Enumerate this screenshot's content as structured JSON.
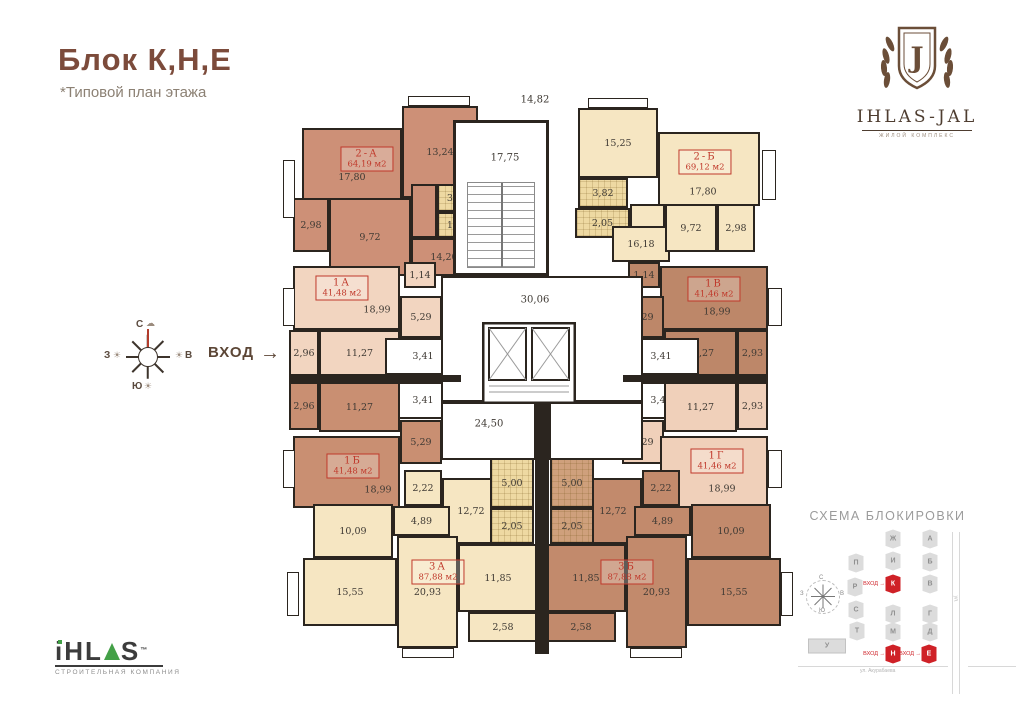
{
  "header": {
    "title": "Блок К,Н,Е",
    "subtitle": "*Типовой план этажа"
  },
  "brand_top": {
    "monogram": "J",
    "name": "IHLAS-JAL",
    "tagline": "ЖИЛОЙ КОМПЛЕКС"
  },
  "brand_bottom": {
    "name_pre": "iHL",
    "name_post": "S",
    "tm": "™",
    "tagline": "СТРОИТЕЛЬНАЯ КОМПАНИЯ"
  },
  "entrance": {
    "label": "ВХОД",
    "arrow": "→"
  },
  "compass": {
    "n": "С",
    "s": "Ю",
    "w": "З",
    "e": "В",
    "cloud": "☁",
    "sun": "☀"
  },
  "plan": {
    "wall_color": "#2b251f",
    "label_color": "#c0392b",
    "apartments": [
      {
        "id": "2A",
        "name": "2-А",
        "area": "64,19 м2",
        "color": "#cd9077",
        "label_x": 367,
        "label_y": 159
      },
      {
        "id": "2B",
        "name": "2-Б",
        "area": "69,12 м2",
        "color": "#f6e6c2",
        "label_x": 705,
        "label_y": 162
      },
      {
        "id": "1A",
        "name": "1А",
        "area": "41,48 м2",
        "color": "#f2d5c0",
        "label_x": 342,
        "label_y": 288
      },
      {
        "id": "1V",
        "name": "1В",
        "area": "41,46 м2",
        "color": "#bd8769",
        "label_x": 714,
        "label_y": 289
      },
      {
        "id": "1B",
        "name": "1Б",
        "area": "41,48 м2",
        "color": "#c98f72",
        "label_x": 353,
        "label_y": 466
      },
      {
        "id": "1G",
        "name": "1Г",
        "area": "41,46 м2",
        "color": "#f0d0ba",
        "label_x": 717,
        "label_y": 461
      },
      {
        "id": "3A",
        "name": "3А",
        "area": "87,88 м2",
        "color": "#f6e6c2",
        "label_x": 438,
        "label_y": 572
      },
      {
        "id": "3B",
        "name": "3Б",
        "area": "87,88 м2",
        "color": "#c28a6c",
        "label_x": 627,
        "label_y": 572
      }
    ],
    "rooms": [
      {
        "apt": "2A",
        "label": "17,80",
        "x": 302,
        "y": 128,
        "w": 100,
        "h": 98
      },
      {
        "apt": "2A",
        "label": "13,24",
        "x": 402,
        "y": 106,
        "w": 76,
        "h": 92
      },
      {
        "apt": "2A",
        "label": "2,98",
        "x": 293,
        "y": 198,
        "w": 36,
        "h": 54
      },
      {
        "apt": "2A",
        "label": "9,72",
        "x": 329,
        "y": 198,
        "w": 82,
        "h": 78
      },
      {
        "apt": "2A",
        "label": "",
        "x": 411,
        "y": 184,
        "w": 26,
        "h": 54
      },
      {
        "apt": "2A",
        "label": "3,26",
        "x": 437,
        "y": 184,
        "w": 41,
        "h": 28,
        "bg": "#eed9a2",
        "tile": true
      },
      {
        "apt": "2A",
        "label": "1,66",
        "x": 437,
        "y": 212,
        "w": 41,
        "h": 26,
        "bg": "#eed9a2",
        "tile": true
      },
      {
        "apt": "2A",
        "label": "14,20",
        "x": 411,
        "y": 238,
        "w": 66,
        "h": 38
      },
      {
        "apt": "1A",
        "label": "18,99",
        "x": 293,
        "y": 266,
        "w": 107,
        "h": 64,
        "lx": 82,
        "ly": 42
      },
      {
        "apt": "1A",
        "label": "1,14",
        "x": 404,
        "y": 262,
        "w": 32,
        "h": 26
      },
      {
        "apt": "1A",
        "label": "5,29",
        "x": 400,
        "y": 296,
        "w": 42,
        "h": 42
      },
      {
        "apt": "1A",
        "label": "2,96",
        "x": 289,
        "y": 330,
        "w": 30,
        "h": 46
      },
      {
        "apt": "1A",
        "label": "11,27",
        "x": 319,
        "y": 330,
        "w": 81,
        "h": 46
      },
      {
        "apt": "1A",
        "label": "3,41",
        "x": 385,
        "y": 338,
        "w": 76,
        "h": 37,
        "white": true
      },
      {
        "apt": "1B",
        "label": "3,41",
        "x": 385,
        "y": 382,
        "w": 76,
        "h": 37,
        "white": true
      },
      {
        "apt": "1B",
        "label": "2,96",
        "x": 289,
        "y": 382,
        "w": 30,
        "h": 48
      },
      {
        "apt": "1B",
        "label": "11,27",
        "x": 319,
        "y": 382,
        "w": 81,
        "h": 50
      },
      {
        "apt": "1B",
        "label": "5,29",
        "x": 400,
        "y": 420,
        "w": 42,
        "h": 44
      },
      {
        "apt": "1B",
        "label": "18,99",
        "x": 293,
        "y": 436,
        "w": 107,
        "h": 72,
        "lx": 83,
        "ly": 52
      },
      {
        "apt": "3A",
        "label": "2,22",
        "x": 404,
        "y": 470,
        "w": 38,
        "h": 36
      },
      {
        "apt": "3A",
        "label": "12,72",
        "x": 442,
        "y": 478,
        "w": 58,
        "h": 66
      },
      {
        "apt": "3A",
        "label": "4,89",
        "x": 393,
        "y": 506,
        "w": 57,
        "h": 30
      },
      {
        "apt": "3A",
        "label": "10,09",
        "x": 313,
        "y": 504,
        "w": 80,
        "h": 54
      },
      {
        "apt": "3A",
        "label": "15,55",
        "x": 303,
        "y": 558,
        "w": 94,
        "h": 68
      },
      {
        "apt": "3A",
        "label": "20,93",
        "x": 397,
        "y": 536,
        "w": 61,
        "h": 112
      },
      {
        "apt": "3A",
        "label": "5,00",
        "x": 490,
        "y": 458,
        "w": 44,
        "h": 50,
        "bg": "#eed9a2",
        "tile": true
      },
      {
        "apt": "3A",
        "label": "2,05",
        "x": 490,
        "y": 508,
        "w": 44,
        "h": 36,
        "bg": "#eed9a2",
        "tile": true
      },
      {
        "apt": "3A",
        "label": "11,85",
        "x": 458,
        "y": 544,
        "w": 80,
        "h": 68
      },
      {
        "apt": "3A",
        "label": "2,58",
        "x": 468,
        "y": 612,
        "w": 70,
        "h": 30
      },
      {
        "apt": "2B",
        "label": "15,25",
        "x": 578,
        "y": 108,
        "w": 80,
        "h": 70
      },
      {
        "apt": "2B",
        "label": "17,80",
        "x": 658,
        "y": 132,
        "w": 102,
        "h": 74,
        "lx": 43,
        "ly": 58
      },
      {
        "apt": "2B",
        "label": "3,82",
        "x": 578,
        "y": 178,
        "w": 50,
        "h": 30,
        "bg": "#eed9a2",
        "tile": true
      },
      {
        "apt": "2B",
        "label": "2,05",
        "x": 575,
        "y": 208,
        "w": 55,
        "h": 30,
        "bg": "#eed9a2",
        "tile": true
      },
      {
        "apt": "2B",
        "label": "16,18",
        "x": 612,
        "y": 226,
        "w": 58,
        "h": 36
      },
      {
        "apt": "2B",
        "label": "",
        "x": 630,
        "y": 204,
        "w": 35,
        "h": 24
      },
      {
        "apt": "2B",
        "label": "9,72",
        "x": 665,
        "y": 204,
        "w": 52,
        "h": 48
      },
      {
        "apt": "2B",
        "label": "2,98",
        "x": 717,
        "y": 204,
        "w": 38,
        "h": 48
      },
      {
        "apt": "1V",
        "label": "1,14",
        "x": 628,
        "y": 262,
        "w": 32,
        "h": 26
      },
      {
        "apt": "1V",
        "label": "18,99",
        "x": 660,
        "y": 266,
        "w": 108,
        "h": 64,
        "lx": 55,
        "ly": 44
      },
      {
        "apt": "1V",
        "label": "5,29",
        "x": 622,
        "y": 296,
        "w": 42,
        "h": 42
      },
      {
        "apt": "1V",
        "label": "11,27",
        "x": 664,
        "y": 330,
        "w": 73,
        "h": 46
      },
      {
        "apt": "1V",
        "label": "2,93",
        "x": 737,
        "y": 330,
        "w": 31,
        "h": 46
      },
      {
        "apt": "1V",
        "label": "3,41",
        "x": 623,
        "y": 338,
        "w": 76,
        "h": 37,
        "white": true
      },
      {
        "apt": "1G",
        "label": "3,41",
        "x": 623,
        "y": 382,
        "w": 76,
        "h": 37,
        "white": true
      },
      {
        "apt": "1G",
        "label": "11,27",
        "x": 664,
        "y": 382,
        "w": 73,
        "h": 50
      },
      {
        "apt": "1G",
        "label": "2,93",
        "x": 737,
        "y": 382,
        "w": 31,
        "h": 48
      },
      {
        "apt": "1G",
        "label": "5,29",
        "x": 622,
        "y": 420,
        "w": 42,
        "h": 44
      },
      {
        "apt": "1G",
        "label": "18,99",
        "x": 660,
        "y": 436,
        "w": 108,
        "h": 72,
        "lx": 60,
        "ly": 51
      },
      {
        "apt": "3B",
        "label": "2,22",
        "x": 642,
        "y": 470,
        "w": 38,
        "h": 36
      },
      {
        "apt": "3B",
        "label": "12,72",
        "x": 584,
        "y": 478,
        "w": 58,
        "h": 66
      },
      {
        "apt": "3B",
        "label": "4,89",
        "x": 634,
        "y": 506,
        "w": 57,
        "h": 30
      },
      {
        "apt": "3B",
        "label": "10,09",
        "x": 691,
        "y": 504,
        "w": 80,
        "h": 54
      },
      {
        "apt": "3B",
        "label": "15,55",
        "x": 687,
        "y": 558,
        "w": 94,
        "h": 68
      },
      {
        "apt": "3B",
        "label": "20,93",
        "x": 626,
        "y": 536,
        "w": 61,
        "h": 112
      },
      {
        "apt": "3B",
        "label": "5,00",
        "x": 550,
        "y": 458,
        "w": 44,
        "h": 50,
        "bg": "#cfa07c",
        "tile": true
      },
      {
        "apt": "3B",
        "label": "2,05",
        "x": 550,
        "y": 508,
        "w": 44,
        "h": 36,
        "bg": "#cfa07c",
        "tile": true
      },
      {
        "apt": "3B",
        "label": "11,85",
        "x": 546,
        "y": 544,
        "w": 80,
        "h": 68
      },
      {
        "apt": "3B",
        "label": "2,58",
        "x": 546,
        "y": 612,
        "w": 70,
        "h": 30
      }
    ],
    "dims": [
      {
        "text": "14,82",
        "x": 535,
        "y": 100
      },
      {
        "text": "17,75",
        "x": 505,
        "y": 158
      },
      {
        "text": "30,06",
        "x": 535,
        "y": 300
      },
      {
        "text": "24,50",
        "x": 489,
        "y": 424
      }
    ],
    "balconies": [
      {
        "x": 283,
        "y": 160,
        "w": 12,
        "h": 58
      },
      {
        "x": 283,
        "y": 288,
        "w": 12,
        "h": 38
      },
      {
        "x": 283,
        "y": 450,
        "w": 12,
        "h": 38
      },
      {
        "x": 287,
        "y": 572,
        "w": 12,
        "h": 44
      },
      {
        "x": 762,
        "y": 150,
        "w": 14,
        "h": 50
      },
      {
        "x": 768,
        "y": 288,
        "w": 14,
        "h": 38
      },
      {
        "x": 768,
        "y": 450,
        "w": 14,
        "h": 38
      },
      {
        "x": 781,
        "y": 572,
        "w": 12,
        "h": 44
      },
      {
        "x": 408,
        "y": 96,
        "w": 62,
        "h": 10
      },
      {
        "x": 588,
        "y": 98,
        "w": 60,
        "h": 10
      },
      {
        "x": 402,
        "y": 648,
        "w": 52,
        "h": 10
      },
      {
        "x": 630,
        "y": 648,
        "w": 52,
        "h": 10
      }
    ]
  },
  "schema": {
    "title": "СХЕМА БЛОКИРОВКИ",
    "entry_label": "ВХОД →",
    "street_h": "ул. Акурабаева",
    "street_v": "ул.",
    "compass": {
      "n": "С",
      "s": "Ю",
      "w": "З",
      "e": "В"
    },
    "blocks": [
      {
        "letter": "Ж",
        "x": 893,
        "y": 539
      },
      {
        "letter": "И",
        "x": 893,
        "y": 561
      },
      {
        "letter": "К",
        "x": 893,
        "y": 584,
        "red": true
      },
      {
        "letter": "А",
        "x": 930,
        "y": 539
      },
      {
        "letter": "Б",
        "x": 930,
        "y": 562
      },
      {
        "letter": "В",
        "x": 930,
        "y": 584
      },
      {
        "letter": "П",
        "x": 856,
        "y": 563
      },
      {
        "letter": "Р",
        "x": 855,
        "y": 587
      },
      {
        "letter": "С",
        "x": 856,
        "y": 610
      },
      {
        "letter": "Т",
        "x": 857,
        "y": 631
      },
      {
        "letter": "Л",
        "x": 893,
        "y": 614
      },
      {
        "letter": "М",
        "x": 893,
        "y": 632
      },
      {
        "letter": "Н",
        "x": 893,
        "y": 654,
        "red": true
      },
      {
        "letter": "Г",
        "x": 930,
        "y": 614
      },
      {
        "letter": "Д",
        "x": 930,
        "y": 632
      },
      {
        "letter": "Е",
        "x": 929,
        "y": 654,
        "red": true
      },
      {
        "letter": "У",
        "x": 827,
        "y": 646,
        "wide": true
      }
    ],
    "entries": [
      {
        "x": 885,
        "y": 584
      },
      {
        "x": 885,
        "y": 654
      },
      {
        "x": 921,
        "y": 654
      }
    ]
  }
}
